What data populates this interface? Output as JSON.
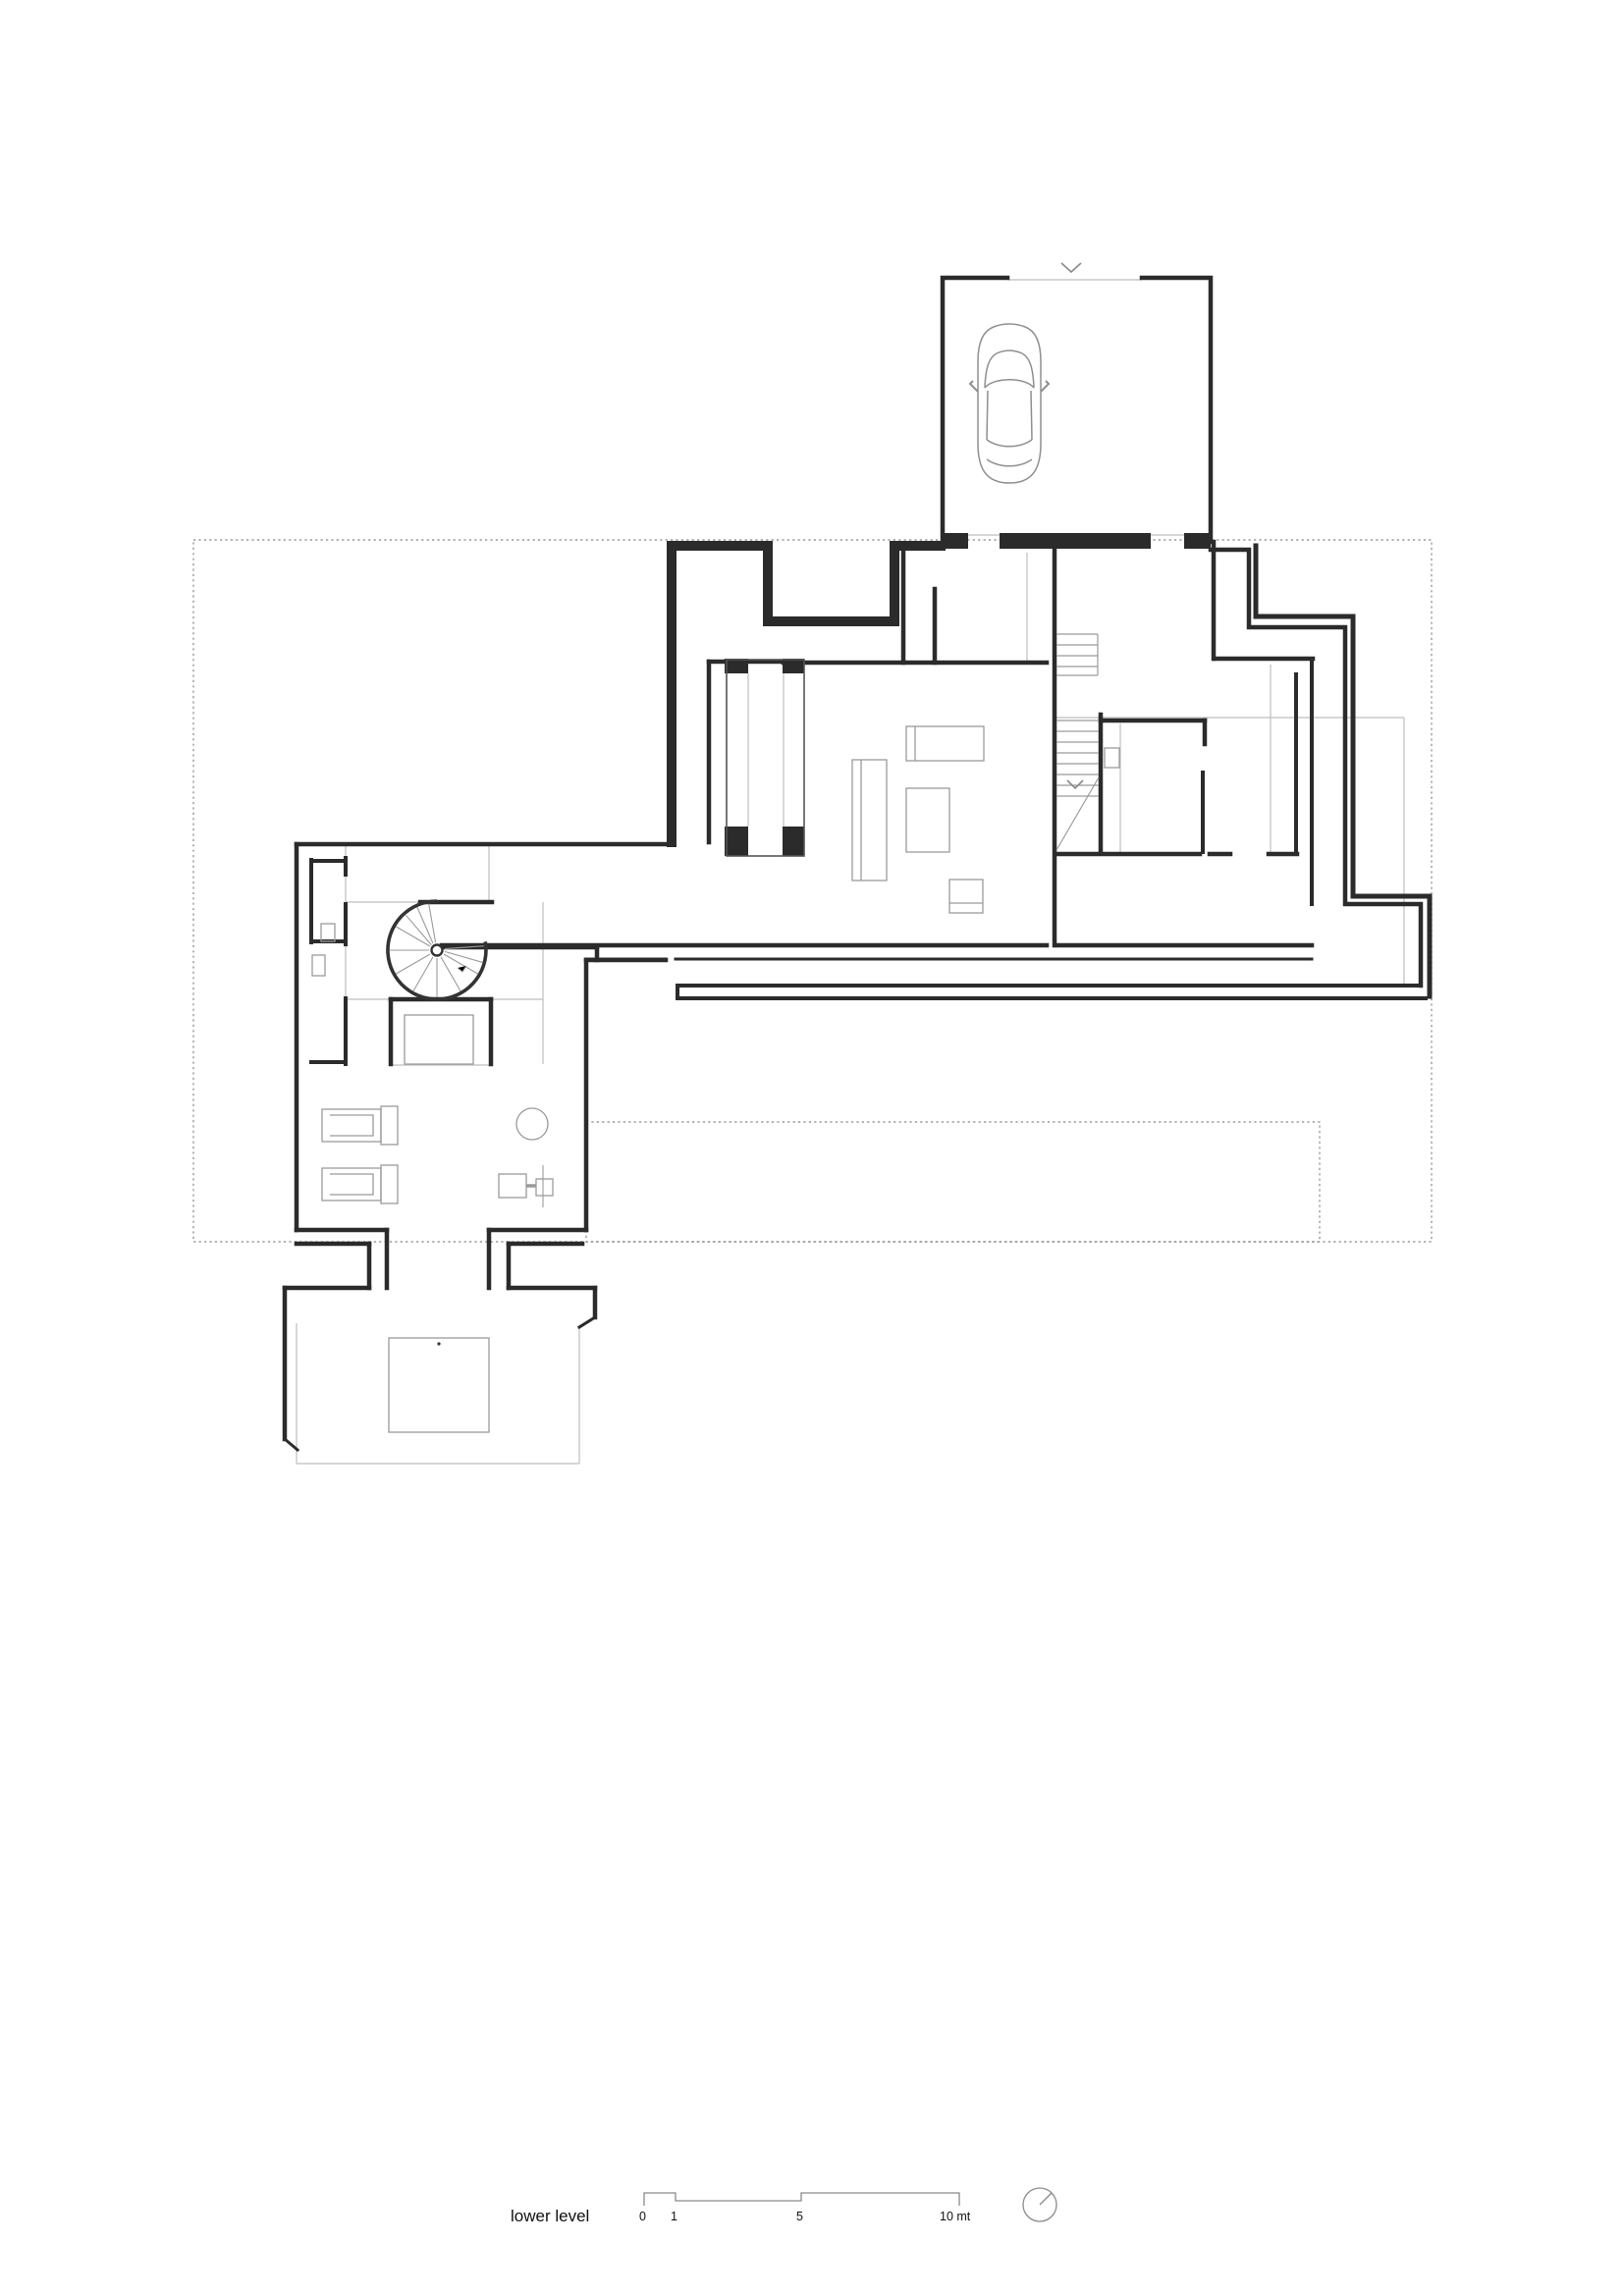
{
  "page": {
    "type": "architectural floor plan drawing",
    "background": "#ffffff"
  },
  "legend": {
    "title": "lower level",
    "scale": {
      "unit": "mt",
      "ticks": [
        {
          "label": "0"
        },
        {
          "label": "1"
        },
        {
          "label": "5"
        },
        {
          "label": "10 mt"
        }
      ]
    }
  },
  "annotations": {
    "garage_entry_marker": "∨",
    "stair_direction_marker": "∨"
  },
  "icons": {
    "car": "car-top-view-outline",
    "north_indicator": "north-circle-with-needle",
    "spiral_stair": "spiral-staircase",
    "straight_stair": "straight-staircase-treads",
    "scale_bar": "alternating-step-scale-bar",
    "lounger": "sun-lounger-outline",
    "stool": "round-stool-outline",
    "lift": "lift-shaft-box"
  },
  "colors": {
    "wall": "#2b2b2b",
    "wall_light": "#444444",
    "thin_line": "#999999",
    "light_line": "#b8b8b8",
    "dashed_boundary": "#9a9a9a",
    "furniture_line": "#8f8f8f",
    "text": "#111111"
  }
}
